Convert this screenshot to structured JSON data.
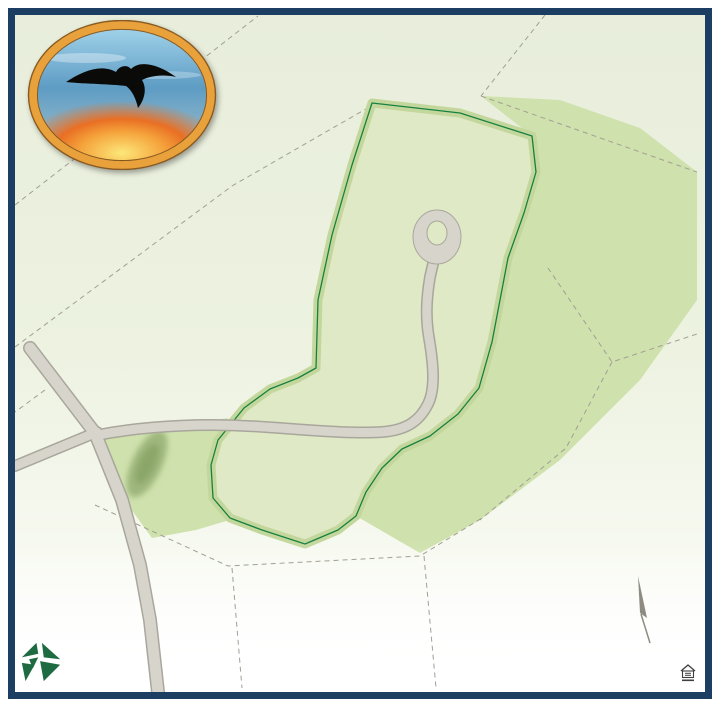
{
  "logo": {
    "title_arc": "ROLLING WOODS",
    "title_sub": "PRESERVE"
  },
  "map": {
    "area_labels": [
      {
        "text": "EXISTING\nRESIDENCES",
        "x": 305,
        "y": 131
      },
      {
        "text": "EXISTING\nRESIDENCES",
        "x": 152,
        "y": 219
      },
      {
        "text": "EXISTING\nRESIDENCES",
        "x": 163,
        "y": 337
      },
      {
        "text": "EXISTING\nRESIDENCES",
        "x": 210,
        "y": 551
      },
      {
        "text": "EXISTING\nRESIDENCES",
        "x": 395,
        "y": 536
      },
      {
        "text": "CONSERVATION\nLAND",
        "x": 600,
        "y": 73
      },
      {
        "text": "CONSERVATION\nLAND",
        "x": 608,
        "y": 241
      },
      {
        "text": "OPEN SPACE",
        "x": 176,
        "y": 408
      }
    ],
    "road_labels": [
      {
        "text": "ROLLING WOODS LANE",
        "x": 235,
        "y": 431,
        "rot": -3
      },
      {
        "text": "WEST HAVEN LANE",
        "x": 47,
        "y": 450,
        "rot": -29
      },
      {
        "text": "SANFORD ROAD (STATE ROUTE 109)",
        "x": 126,
        "y": 540,
        "rot": 68
      }
    ],
    "storm_water": {
      "label": "STORM WATER\nMANAGEMENT AREA",
      "acres": "1.05 Acres",
      "x": 133,
      "y": 458,
      "acres_x": 155,
      "acres_y": 437
    },
    "north_label": "N",
    "lots": [
      {
        "number": "1",
        "acres": "0.78 Acres",
        "x": 253,
        "y": 397
      },
      {
        "number": "2",
        "acres": "0.70 Acres",
        "x": 325,
        "y": 382
      },
      {
        "number": "3",
        "acres": "0.79 Acres",
        "x": 352,
        "y": 340
      },
      {
        "number": "4",
        "acres": "0.78 Acres",
        "x": 352,
        "y": 298
      },
      {
        "number": "5",
        "acres": "0.73 Acres",
        "x": 361,
        "y": 255
      },
      {
        "number": "6",
        "acres": "0.70 Acres",
        "x": 375,
        "y": 204
      },
      {
        "number": "7",
        "acres": "0.77 Acres",
        "x": 415,
        "y": 154
      },
      {
        "number": "8",
        "acres": "0.73 Acres",
        "x": 473,
        "y": 154
      },
      {
        "number": "9",
        "acres": "0.72 Acres",
        "x": 510,
        "y": 187
      },
      {
        "number": "10",
        "acres": "0.69 Acres",
        "x": 502,
        "y": 248
      },
      {
        "number": "11",
        "acres": "0.71 Acres",
        "x": 478,
        "y": 287
      },
      {
        "number": "12",
        "acres": "0.79 Acres",
        "x": 478,
        "y": 331
      },
      {
        "number": "13",
        "acres": "0.69 Acres",
        "x": 471,
        "y": 372
      },
      {
        "number": "14",
        "acres": "0.69 Acres",
        "x": 446,
        "y": 410
      },
      {
        "number": "15",
        "acres": "0.69 Acres",
        "x": 404,
        "y": 435
      },
      {
        "number": "16",
        "acres": "1.06 Acres",
        "x": 330,
        "y": 485
      },
      {
        "number": "17",
        "acres": "0.89 Acres",
        "x": 243,
        "y": 485
      }
    ]
  },
  "builder": {
    "name": "PATCO",
    "subtitle": "CONSTRUCTION"
  },
  "footer": {
    "disclaimer_line1": "This image is an artist's rendering. Lot sizes and improvement locations are approximate. Landscaping is for illustrative purposes only. Easements and other conditions are",
    "disclaimer_line2": "not shown on this plan. Refer to approved engineering plans for homesite specific information. Not responsible for errors or omissions. Subject to change without notice.",
    "date": "1/2025"
  },
  "colors": {
    "frame": "#1c3e63",
    "patco_green": "#1e6b41",
    "dev_parcel": "#dfe9c6",
    "conservation": "#cfe1ad",
    "tree": "#55682c",
    "road": "#d7d4cc"
  }
}
